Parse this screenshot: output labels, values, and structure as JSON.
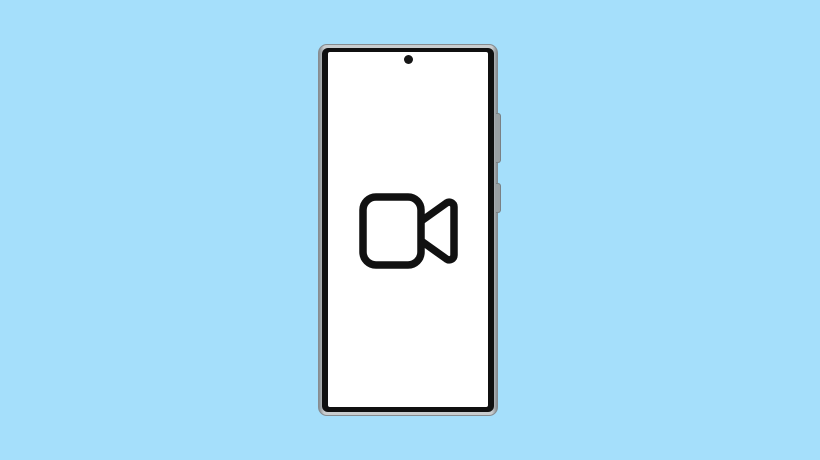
{
  "meta": {
    "description": "Illustration of a smartphone with a video camera icon displayed on its screen",
    "text_content": "none - image contains no visible text"
  },
  "colors": {
    "background": "#a5dffb",
    "frame": "#c9cdcf",
    "frame-edge": "#868c90",
    "bezel": "#101010",
    "screen": "#ffffff",
    "camera-dot": "#161616",
    "icon": "#111111",
    "button": "#9aa0a3",
    "button-edge": "#7a8084"
  },
  "device": {
    "type": "smartphone",
    "orientation": "portrait",
    "screen_content_icon": "video-camera-icon",
    "front_camera": "punch-hole-dot",
    "side_buttons": [
      {
        "name": "volume-button"
      },
      {
        "name": "power-button"
      }
    ]
  }
}
